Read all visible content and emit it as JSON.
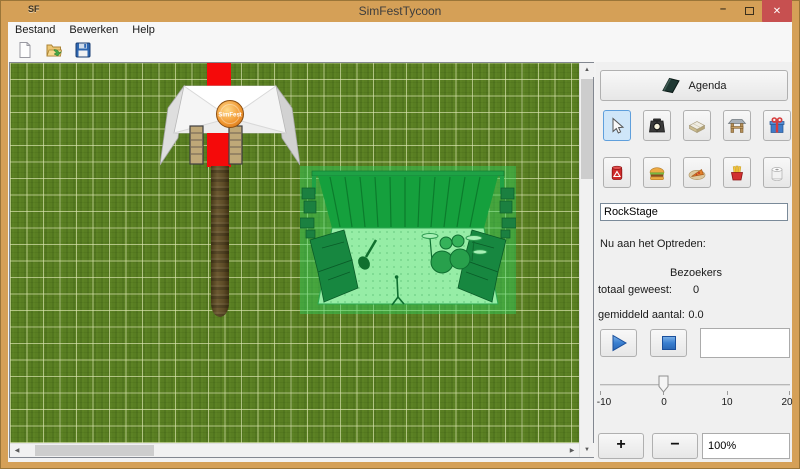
{
  "window": {
    "title": "SimFestTycoon",
    "app_icon_text": "SF",
    "minimize_glyph": "–",
    "close_glyph": "✕"
  },
  "menu": {
    "items": [
      {
        "label": "Bestand"
      },
      {
        "label": "Bewerken"
      },
      {
        "label": "Help"
      }
    ]
  },
  "toolbar": {
    "buttons": [
      {
        "name": "new-file-icon"
      },
      {
        "name": "open-file-icon"
      },
      {
        "name": "save-file-icon"
      }
    ]
  },
  "canvas": {
    "tent_logo_text": "SimFest",
    "placed_objects": [
      "entrance-tent",
      "red-carpet",
      "dirt-path",
      "stage-preview"
    ],
    "scrollbar_glyphs": {
      "up": "▲",
      "down": "▼",
      "left": "◀",
      "right": "▶"
    }
  },
  "panel": {
    "agenda_button_label": "Agenda",
    "tool_buttons": [
      {
        "name": "select-cursor",
        "selected": true
      },
      {
        "name": "spotlight"
      },
      {
        "name": "stage-platform"
      },
      {
        "name": "entrance-gate"
      },
      {
        "name": "gift"
      },
      {
        "name": "trash-can"
      },
      {
        "name": "hamburger"
      },
      {
        "name": "pizza"
      },
      {
        "name": "french-fries"
      },
      {
        "name": "toilet-roll"
      }
    ],
    "stage_name_field": {
      "value": "RockStage"
    },
    "now_performing_label": "Nu aan het Optreden:",
    "visitors_header": "Bezoekers",
    "total_visitors_label": "totaal geweest:",
    "total_visitors_value": "0",
    "average_visitors_label": "gemiddeld aantal:",
    "average_visitors_value": "0.0",
    "speed_slider": {
      "min": -10,
      "max": 20,
      "value": 0,
      "tick_labels": [
        "-10",
        "0",
        "10",
        "20"
      ]
    },
    "zoom_in_label": "+",
    "zoom_out_label": "−",
    "zoom_field": {
      "value": "100%"
    }
  },
  "colors": {
    "titlebar": "#d5a057",
    "close_button": "#c75050",
    "grass": "#597e22",
    "grid_line": "#dce9b6",
    "carpet_red": "#f50a0a",
    "path_brown": "#5c4a26",
    "stage_tint": "#2fd35f",
    "selected_tool_bg": "#cfe6f9",
    "selected_tool_border": "#5f9fdc",
    "play_stop_blue": "#3a7fd0"
  }
}
